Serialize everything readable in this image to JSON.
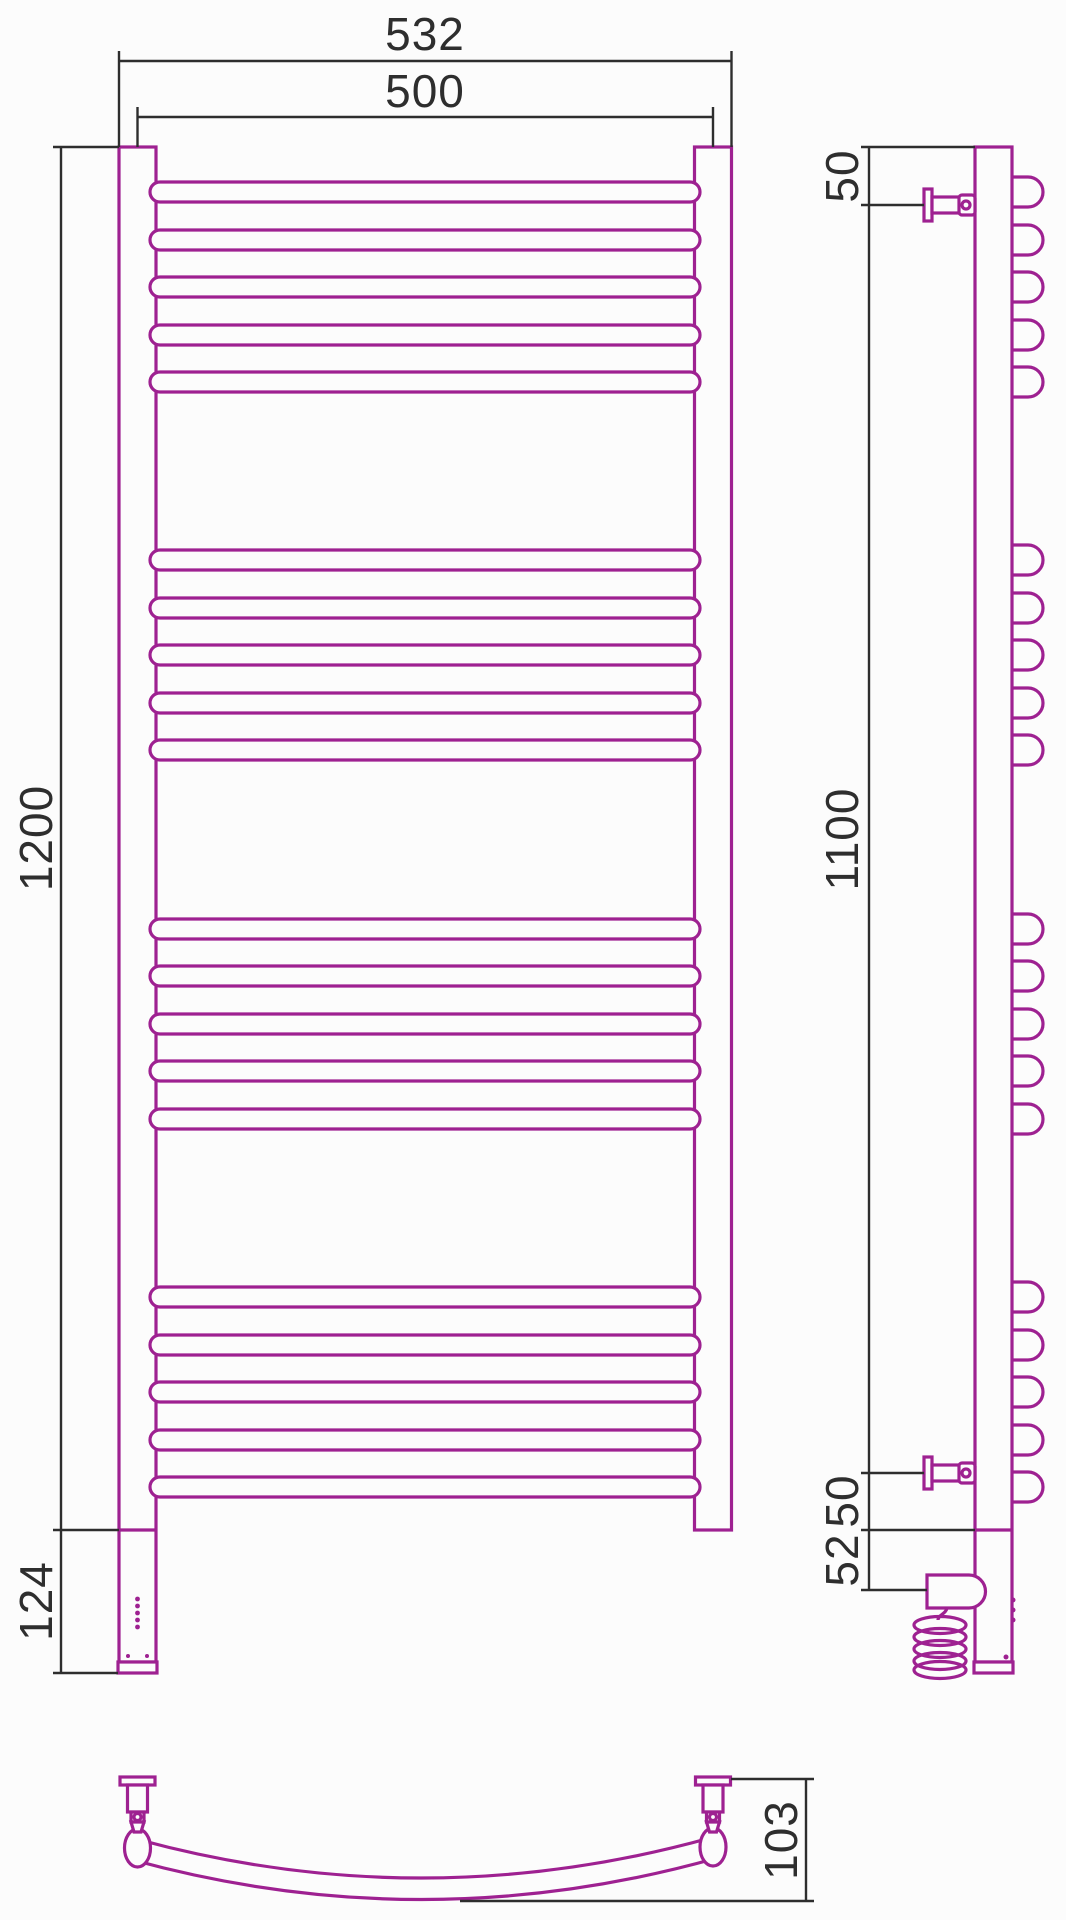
{
  "drawing": {
    "type": "towel-rail technical drawing",
    "views": {
      "front": {
        "dim_width_overall": "532",
        "dim_width_centers": "500",
        "dim_height": "1200",
        "dim_heater_section": "124"
      },
      "side": {
        "dim_top_to_bracket": "50",
        "dim_bracket_span": "1100",
        "dim_bracket_to_bottom": "50",
        "dim_bottom_to_heater": "52"
      },
      "bottom": {
        "dim_bar_depth": "103"
      }
    },
    "bar_groups": 4,
    "bars_per_group": 5
  },
  "colors": {
    "prod": "#9e2191",
    "dim": "#2e2e2e",
    "bg": "#fcfcfc"
  }
}
